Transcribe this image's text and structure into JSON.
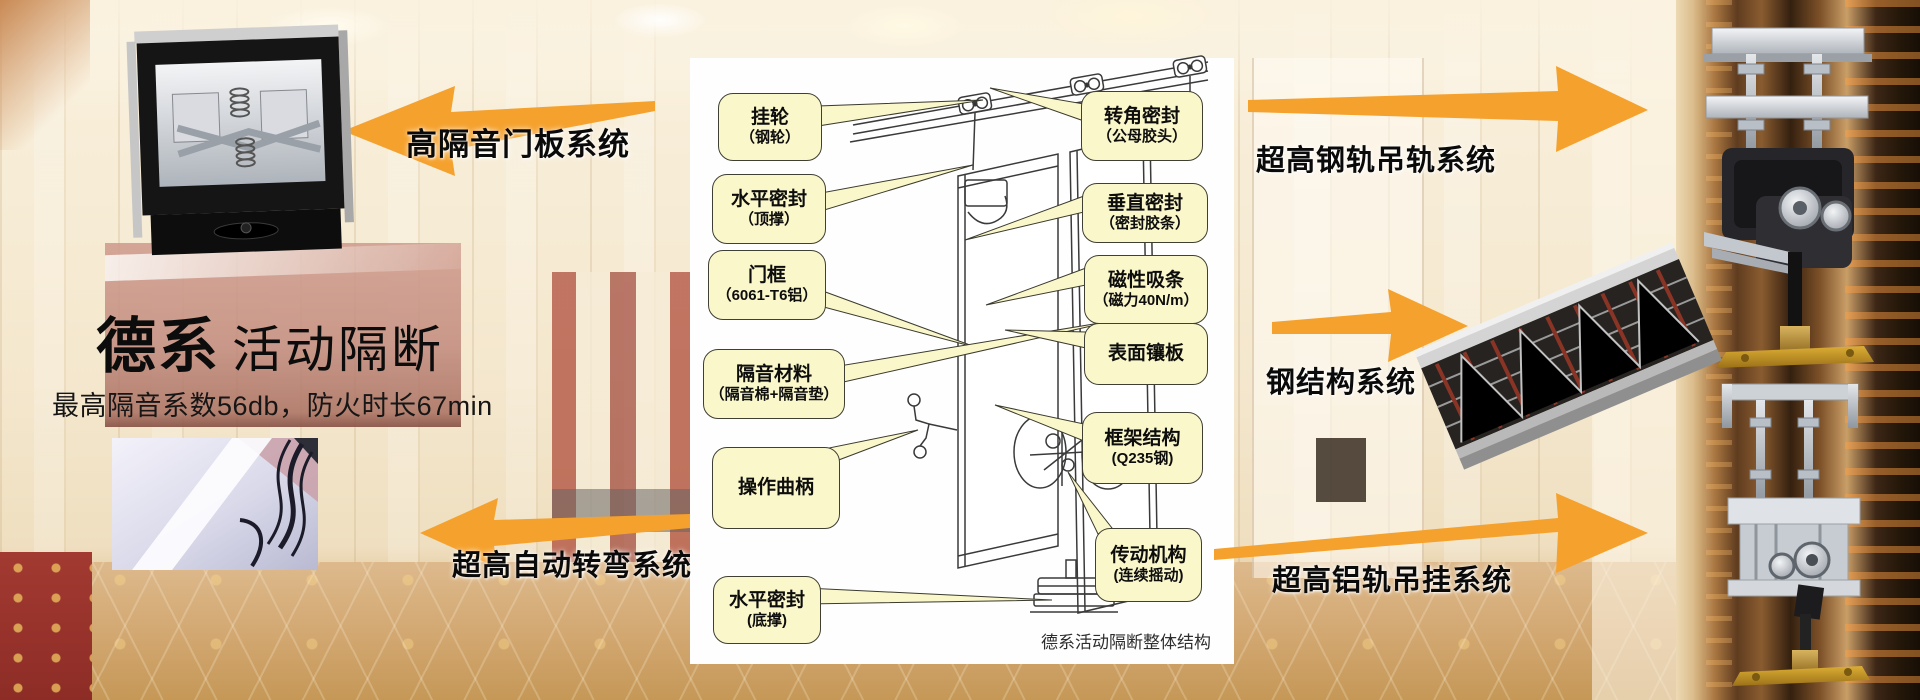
{
  "title": {
    "brand": "德系",
    "product": "活动隔断",
    "subtitle": "最高隔音系数56db，防火时长67min"
  },
  "arrows": {
    "door_panel": {
      "label": "高隔音门板系统",
      "direction": "left"
    },
    "auto_turn": {
      "label": "超高自动转弯系统",
      "direction": "left"
    },
    "steel_rail": {
      "label": "超高钢轨吊轨系统",
      "direction": "right"
    },
    "steel_structure": {
      "label": "钢结构系统",
      "direction": "right"
    },
    "alu_rail": {
      "label": "超高铝轨吊挂系统",
      "direction": "right"
    }
  },
  "diagram": {
    "caption": "德系活动隔断整体结构",
    "callouts_left": [
      {
        "line1": "挂轮",
        "line2": "（钢轮）"
      },
      {
        "line1": "水平密封",
        "line2": "（顶撑）"
      },
      {
        "line1": "门框",
        "line2": "（6061-T6铝）"
      },
      {
        "line1": "隔音材料",
        "line2": "（隔音棉+隔音垫）"
      },
      {
        "line1": "操作曲柄",
        "line2": ""
      },
      {
        "line1": "水平密封",
        "line2": "(底撑)"
      }
    ],
    "callouts_right": [
      {
        "line1": "转角密封",
        "line2": "（公母胶头）"
      },
      {
        "line1": "垂直密封",
        "line2": "（密封胶条）"
      },
      {
        "line1": "磁性吸条",
        "line2": "（磁力40N/m）"
      },
      {
        "line1": "表面镶板",
        "line2": ""
      },
      {
        "line1": "框架结构",
        "line2": "(Q235钢)"
      },
      {
        "line1": "传动机构",
        "line2": "(连续摇动)"
      }
    ]
  },
  "colors": {
    "arrow_orange": "#F5A12D",
    "callout_bg": "#FAF7CA",
    "callout_border": "#3F3F33",
    "panel_white": "#FEFEFE"
  }
}
